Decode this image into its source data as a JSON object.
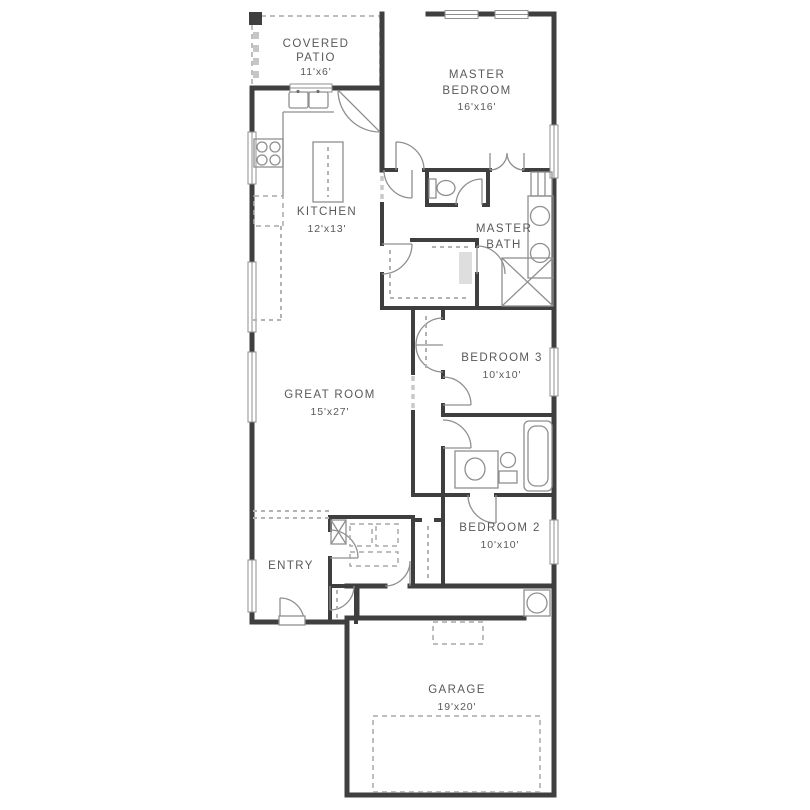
{
  "plan": {
    "rooms": {
      "covered_patio": {
        "line1": "COVERED",
        "line2": "PATIO",
        "dims": "11'x6'"
      },
      "master_bedroom": {
        "line1": "MASTER",
        "line2": "BEDROOM",
        "dims": "16'x16'"
      },
      "kitchen": {
        "line1": "KITCHEN",
        "dims": "12'x13'"
      },
      "master_bath": {
        "line1": "MASTER",
        "line2": "BATH"
      },
      "bedroom_3": {
        "line1": "BEDROOM 3",
        "dims": "10'x10'"
      },
      "great_room": {
        "line1": "GREAT ROOM",
        "dims": "15'x27'"
      },
      "bedroom_2": {
        "line1": "BEDROOM 2",
        "dims": "10'x10'"
      },
      "entry": {
        "line1": "ENTRY"
      },
      "garage": {
        "line1": "GARAGE",
        "dims": "19'x20'"
      }
    },
    "colors": {
      "wall": "#3f3f3f",
      "fixture_line": "#8f8f8f",
      "dash_line": "#b3b3b3",
      "label_text": "#58595b",
      "background": "#ffffff"
    }
  }
}
